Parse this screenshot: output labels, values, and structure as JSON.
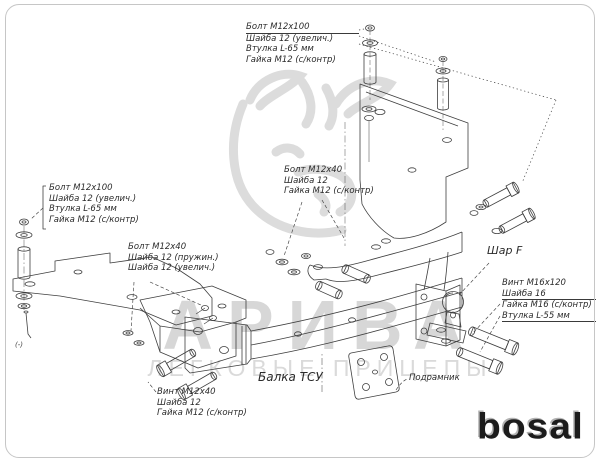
{
  "watermark": {
    "brand": "АРИВА",
    "tagline": "ЛЕГКОВЫЕ ПРИЦЕПЫ"
  },
  "brand_logo": "bosal",
  "part_labels": {
    "beam": "Балка ТСУ",
    "subframe": "Подрамник",
    "ball": "Шар F",
    "left_pin_mark": "(-)"
  },
  "hardware_labels": {
    "top": [
      "Болт М12х100",
      "Шайба 12 (увелич.)",
      "Втулка L-65 мм",
      "Гайка М12 (с/контр)"
    ],
    "left": [
      "Болт М12х100",
      "Шайба 12 (увелич.)",
      "Втулка L-65 мм",
      "Гайка М12 (с/контр)"
    ],
    "center": [
      "Болт М12х40",
      "Шайба 12",
      "Гайка М12 (с/контр)"
    ],
    "mid_left": [
      "Болт М12х40",
      "Шайба 12 (пружин.)",
      "Шайба 12 (увелич.)"
    ],
    "bottom_left": [
      "Винт М12х40",
      "Шайба 12",
      "Гайка М12 (с/контр)"
    ],
    "ball": [
      "Винт М16х120",
      "Шайба 16",
      "Гайка М16 (с/контр)",
      "Втулка L-55 мм"
    ]
  },
  "colors": {
    "drawing_line": "#3f3f3f",
    "watermark_gray": "#d8d8d8",
    "logo_black": "#1c1c1c",
    "frame_border": "#c6c6c6"
  }
}
